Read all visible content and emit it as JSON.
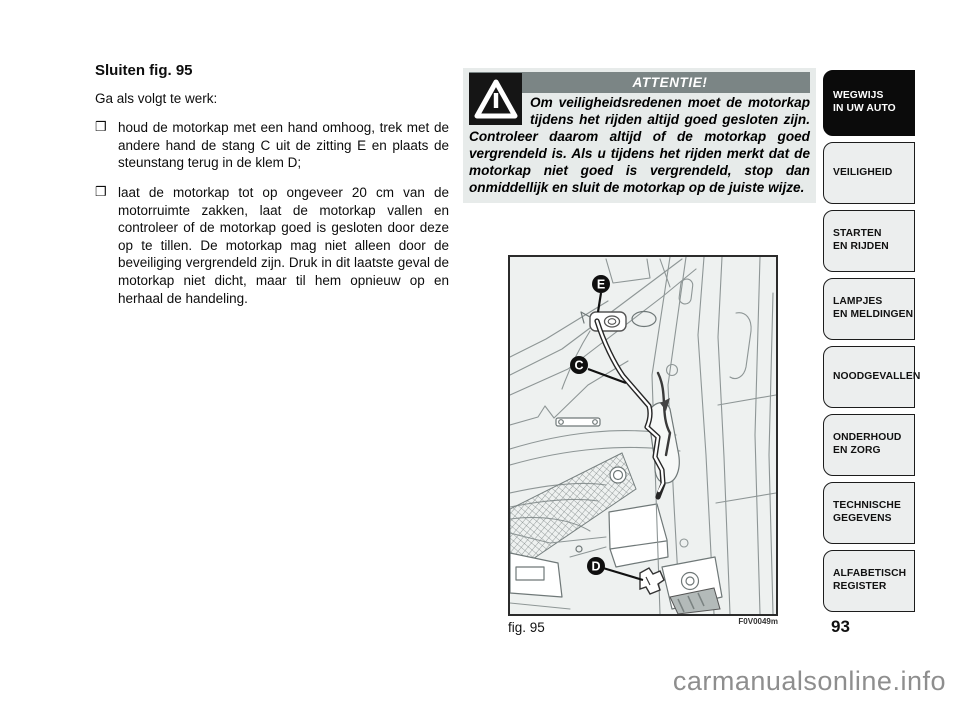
{
  "page": {
    "number": "93",
    "watermark": "carmanualsonline.info"
  },
  "left_column": {
    "title": "Sluiten fig. 95",
    "intro": "Ga als volgt te werk:",
    "bullet_marker": "❒",
    "bullets": [
      "houd de motorkap met een hand omhoog, trek met de andere hand de stang C uit de zitting E en plaats de steunstang terug in de klem D;",
      "laat de motorkap tot op ongeveer 20 cm van de motorruimte zakken, laat de motorkap vallen en controleer of de motorkap goed is gesloten door deze op te tillen. De motorkap mag niet alleen door de beveiliging vergrendeld zijn. Druk in dit laatste geval de motorkap niet dicht, maar til hem opnieuw op en herhaal de handeling."
    ]
  },
  "warning_box": {
    "header": "ATTENTIE!",
    "body": "Om veiligheidsredenen moet de motorkap tijdens het rijden altijd goed gesloten zijn. Controleer daarom altijd of de motorkap goed vergrendeld is. Als u tijdens het rijden merkt dat de motorkap niet goed is vergrendeld, stop dan onmiddellijk en sluit de motorkap op de juiste wijze.",
    "colors": {
      "box_bg": "#e7ebea",
      "header_bg": "#7b8585",
      "header_text": "#ffffff",
      "icon_bg": "#151515"
    }
  },
  "figure": {
    "caption": "fig. 95",
    "code": "F0V0049m",
    "labels": [
      "E",
      "C",
      "D"
    ]
  },
  "sidebar": {
    "tabs": [
      {
        "label": "WEGWIJS\nIN UW AUTO",
        "active": true
      },
      {
        "label": "VEILIGHEID",
        "active": false
      },
      {
        "label": "STARTEN\nEN RIJDEN",
        "active": false
      },
      {
        "label": "LAMPJES\nEN MELDINGEN",
        "active": false
      },
      {
        "label": "NOODGEVALLEN",
        "active": false
      },
      {
        "label": "ONDERHOUD\nEN ZORG",
        "active": false
      },
      {
        "label": "TECHNISCHE\nGEGEVENS",
        "active": false
      },
      {
        "label": "ALFABETISCH\nREGISTER",
        "active": false
      }
    ]
  }
}
